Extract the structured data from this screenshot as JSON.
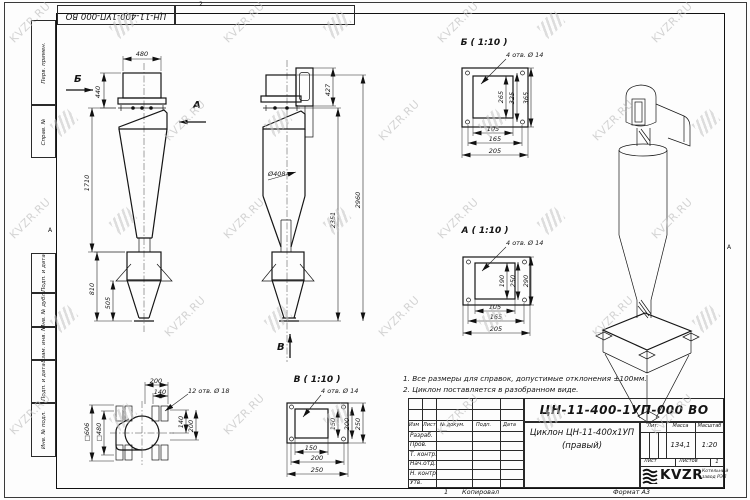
{
  "watermark": {
    "text": "KVZR.RU"
  },
  "sheet": {
    "doc_number_top": "ЦН-11-400-1УП-000 ВО",
    "zone_top": "2",
    "zone_bottom": "1",
    "zone_left": "А",
    "zone_right": "А",
    "left_column_labels": [
      "Перв. примен.",
      "Справ. №",
      "Подп. и дата",
      "Инв. № дубл.",
      "Взам. инв. №",
      "Подп. и дата",
      "Инв. № подл."
    ],
    "copied_label": "Копировал",
    "format_label": "Формат А3"
  },
  "notes": {
    "line1": "1. Все размеры для справок, допустимые отклонения ±100мм.",
    "line2": "2. Циклон поставляется в разобранном виде."
  },
  "views": {
    "front": {
      "dir_b": "Б",
      "dir_a": "А",
      "dim_width": "480",
      "dim_inlet": "440",
      "dim_body": "1710",
      "dim_bunker": "810",
      "dim_cone": "505"
    },
    "side": {
      "dir_v": "В",
      "dim_inlet_h": "427",
      "dim_dia": "Ø408",
      "dim_total": "2960",
      "dim_lower": "2351"
    },
    "detail_b": {
      "title": "Б ( 1:10 )",
      "holes": "4 отв. Ø 14",
      "v1": "265",
      "v2": "325",
      "v3": "365",
      "h1": "105",
      "h2": "165",
      "h3": "205"
    },
    "detail_a": {
      "title": "А ( 1:10 )",
      "holes": "4 отв. Ø 14",
      "v1": "190",
      "v2": "250",
      "v3": "290",
      "h1": "105",
      "h2": "165",
      "h3": "205"
    },
    "detail_v": {
      "title": "В ( 1:10 )",
      "holes": "4 отв. Ø 14",
      "v1": "150",
      "v2": "200",
      "v3": "250",
      "h1": "150",
      "h2": "200",
      "h3": "250"
    },
    "plan": {
      "holes": "12 отв. Ø 18",
      "top1": "200",
      "top2": "140",
      "right1": "140",
      "right2": "200",
      "left1": "□606",
      "left2": "□480"
    }
  },
  "title_block": {
    "doc_number": "ЦН-11-400-1УП-000 ВО",
    "name_line1": "Циклон ЦН-11-400х1УП",
    "name_line2": "(правый)",
    "header": {
      "izm": "Изм",
      "list": "Лист",
      "doc": "№ докум.",
      "podp": "Подп.",
      "data": "Дата"
    },
    "rows": [
      "Разраб.",
      "Пров.",
      "Т. контр.",
      "Нач.отд.",
      "Н. контр.",
      "Утв."
    ],
    "lit_label": "Лит.",
    "mass_label": "Масса",
    "scale_label": "Масштаб",
    "mass_value": "134,1",
    "scale_value": "1:20",
    "sheet_label": "Лист",
    "sheets_label": "Листов",
    "sheets_value": "1",
    "company": {
      "brand": "KVZR",
      "line1": "Котельный",
      "line2": "завод РЭП"
    }
  }
}
